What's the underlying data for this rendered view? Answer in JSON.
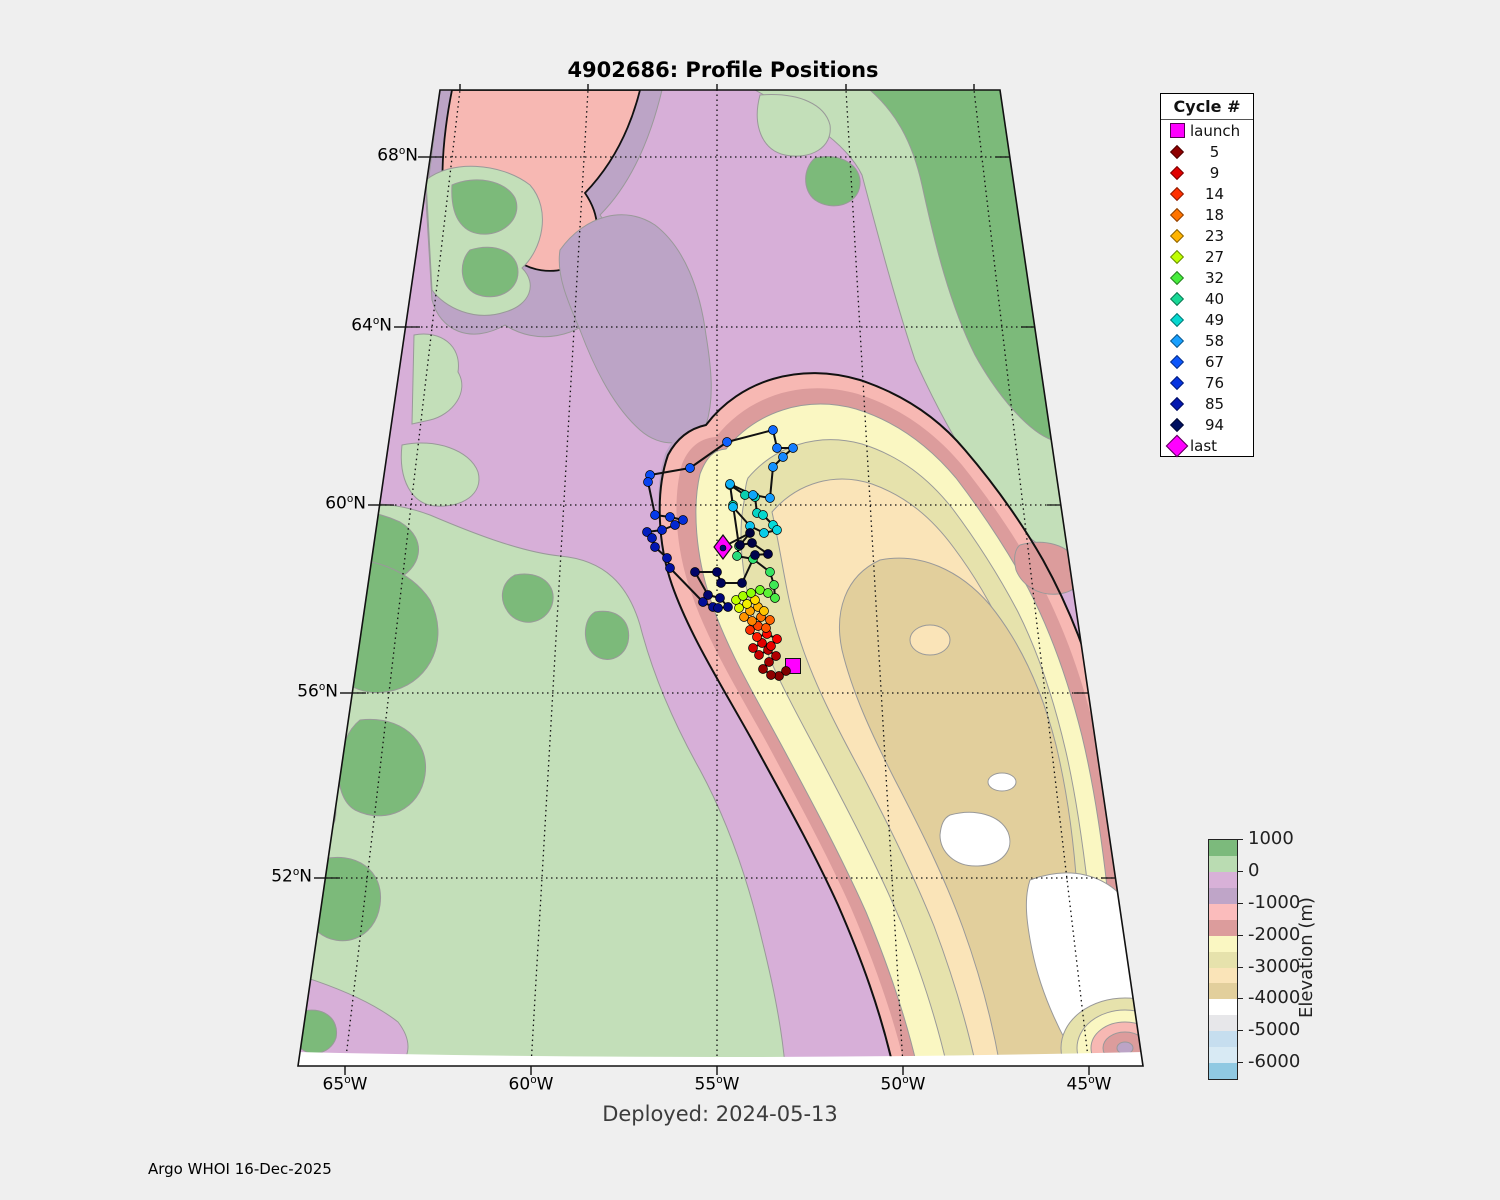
{
  "figure": {
    "title": "4902686: Profile Positions",
    "deployed_label": "Deployed: 2024-05-13",
    "credit": "Argo WHOI 16-Dec-2025"
  },
  "axes": {
    "lat_ticks": [
      {
        "pre": "68",
        "sup": "o",
        "post": "N"
      },
      {
        "pre": "64",
        "sup": "o",
        "post": "N"
      },
      {
        "pre": "60",
        "sup": "o",
        "post": "N"
      },
      {
        "pre": "56",
        "sup": "o",
        "post": "N"
      },
      {
        "pre": "52",
        "sup": "o",
        "post": "N"
      }
    ],
    "lon_ticks": [
      {
        "pre": "65",
        "sup": "o",
        "post": "W"
      },
      {
        "pre": "60",
        "sup": "o",
        "post": "W"
      },
      {
        "pre": "55",
        "sup": "o",
        "post": "W"
      },
      {
        "pre": "50",
        "sup": "o",
        "post": "W"
      },
      {
        "pre": "45",
        "sup": "o",
        "post": "W"
      }
    ]
  },
  "legend": {
    "title": "Cycle #",
    "items": [
      {
        "label": "launch",
        "color": "#FF00FF",
        "marker": "square"
      },
      {
        "label": "5",
        "color": "#8F0000",
        "marker": "diamond"
      },
      {
        "label": "9",
        "color": "#E00000",
        "marker": "diamond"
      },
      {
        "label": "14",
        "color": "#FF3000",
        "marker": "diamond"
      },
      {
        "label": "18",
        "color": "#FF7400",
        "marker": "diamond"
      },
      {
        "label": "23",
        "color": "#FFB400",
        "marker": "diamond"
      },
      {
        "label": "27",
        "color": "#BFFF00",
        "marker": "diamond"
      },
      {
        "label": "32",
        "color": "#46EC3C",
        "marker": "diamond"
      },
      {
        "label": "40",
        "color": "#17D896",
        "marker": "diamond"
      },
      {
        "label": "49",
        "color": "#06D8D0",
        "marker": "diamond"
      },
      {
        "label": "58",
        "color": "#18A0FF",
        "marker": "diamond"
      },
      {
        "label": "67",
        "color": "#0C56FB",
        "marker": "diamond"
      },
      {
        "label": "76",
        "color": "#0534E0",
        "marker": "diamond"
      },
      {
        "label": "85",
        "color": "#0318B0",
        "marker": "diamond"
      },
      {
        "label": "94",
        "color": "#001060",
        "marker": "diamond"
      },
      {
        "label": "last",
        "color": "#FF00FF",
        "marker": "diamond-large"
      }
    ]
  },
  "colorbar": {
    "label": "Elevation (m)",
    "ticks": [
      "1000",
      "0",
      "-1000",
      "-2000",
      "-3000",
      "-4000",
      "-5000",
      "-6000"
    ],
    "segments": [
      "#7CBA7C",
      "#BADCB2",
      "#D8B1D8",
      "#BFA5C8",
      "#FBBCBC",
      "#DC9C9C",
      "#FAF7C2",
      "#E6E2AC",
      "#FAE4B8",
      "#E2CF9C",
      "#FFFFFF",
      "#E7E7EA",
      "#C6DEEF",
      "#D8EAF4",
      "#90C9E2"
    ]
  },
  "trajectory": {
    "line_color": "#111111",
    "launch": {
      "x": 793,
      "y": 666,
      "color": "#FF00FF"
    },
    "last": {
      "x": 723,
      "y": 547,
      "color": "#FF00FF"
    },
    "points": [
      [
        786,
        671,
        "#7F0000"
      ],
      [
        779,
        676,
        "#870000"
      ],
      [
        771,
        675,
        "#8F0000"
      ],
      [
        763,
        669,
        "#970000"
      ],
      [
        769,
        662,
        "#A30000"
      ],
      [
        776,
        656,
        "#AF0000"
      ],
      [
        768,
        650,
        "#BB0000"
      ],
      [
        759,
        655,
        "#C70000"
      ],
      [
        753,
        648,
        "#D30000"
      ],
      [
        762,
        643,
        "#DF0000"
      ],
      [
        771,
        646,
        "#EB0000"
      ],
      [
        777,
        639,
        "#F70000"
      ],
      [
        767,
        634,
        "#FF0800"
      ],
      [
        757,
        637,
        "#FF1C00"
      ],
      [
        750,
        630,
        "#FF3000"
      ],
      [
        758,
        626,
        "#FF4400"
      ],
      [
        766,
        628,
        "#FF5400"
      ],
      [
        770,
        620,
        "#FF6400"
      ],
      [
        761,
        617,
        "#FF7400"
      ],
      [
        752,
        621,
        "#FF8400"
      ],
      [
        744,
        617,
        "#FF9400"
      ],
      [
        750,
        611,
        "#FFA400"
      ],
      [
        758,
        607,
        "#FFB400"
      ],
      [
        764,
        611,
        "#FFC400"
      ],
      [
        755,
        600,
        "#FFDC00"
      ],
      [
        747,
        604,
        "#F2EE00"
      ],
      [
        739,
        608,
        "#D9FB00"
      ],
      [
        736,
        600,
        "#BFFF00"
      ],
      [
        743,
        596,
        "#A5FF00"
      ],
      [
        751,
        593,
        "#8BFF08"
      ],
      [
        760,
        590,
        "#6FFA1E"
      ],
      [
        768,
        593,
        "#5BF235"
      ],
      [
        775,
        598,
        "#4AEC46"
      ],
      [
        774,
        585,
        "#3FE855"
      ],
      [
        770,
        572,
        "#36E462"
      ],
      [
        753,
        559,
        "#2EDF6F"
      ],
      [
        737,
        556,
        "#26DB7C"
      ],
      [
        739,
        546,
        "#1ED689"
      ],
      [
        733,
        505,
        "#16D196"
      ],
      [
        730,
        485,
        "#0ECCA3"
      ],
      [
        745,
        495,
        "#0BCFAE"
      ],
      [
        755,
        497,
        "#08D2B9"
      ],
      [
        757,
        513,
        "#06D5C4"
      ],
      [
        763,
        515,
        "#04D8CF"
      ],
      [
        773,
        525,
        "#04DCDA"
      ],
      [
        777,
        530,
        "#06D5E2"
      ],
      [
        764,
        533,
        "#08CDE8"
      ],
      [
        750,
        526,
        "#0AC4EE"
      ],
      [
        733,
        507,
        "#0CBAF3"
      ],
      [
        730,
        484,
        "#0EB0F7"
      ],
      [
        753,
        495,
        "#10A6FA"
      ],
      [
        770,
        498,
        "#129CFD"
      ],
      [
        773,
        467,
        "#1492FF"
      ],
      [
        783,
        457,
        "#1588FF"
      ],
      [
        793,
        448,
        "#147EFF"
      ],
      [
        777,
        448,
        "#1274FF"
      ],
      [
        773,
        430,
        "#106AFF"
      ],
      [
        727,
        442,
        "#0E60FF"
      ],
      [
        690,
        468,
        "#0C56FB"
      ],
      [
        650,
        475,
        "#0A4CF5"
      ],
      [
        648,
        482,
        "#0842EF"
      ],
      [
        655,
        515,
        "#063AE8"
      ],
      [
        670,
        517,
        "#0534E0"
      ],
      [
        683,
        520,
        "#042ED8"
      ],
      [
        675,
        525,
        "#0428D0"
      ],
      [
        662,
        530,
        "#0322C8"
      ],
      [
        647,
        532,
        "#031EC0"
      ],
      [
        652,
        538,
        "#021AB8"
      ],
      [
        655,
        547,
        "#0216B0"
      ],
      [
        667,
        558,
        "#0212A8"
      ],
      [
        670,
        568,
        "#0210A0"
      ],
      [
        703,
        602,
        "#020E98"
      ],
      [
        713,
        607,
        "#010C90"
      ],
      [
        718,
        608,
        "#010A88"
      ],
      [
        728,
        607,
        "#010880"
      ],
      [
        720,
        598,
        "#010678"
      ],
      [
        708,
        595,
        "#010570"
      ],
      [
        695,
        572,
        "#010468"
      ],
      [
        717,
        572,
        "#000360"
      ],
      [
        721,
        583,
        "#000358"
      ],
      [
        742,
        583,
        "#000250"
      ],
      [
        755,
        555,
        "#00024C"
      ],
      [
        768,
        554,
        "#000248"
      ],
      [
        752,
        543,
        "#000144"
      ],
      [
        740,
        545,
        "#000140"
      ],
      [
        750,
        533,
        "#00013C"
      ]
    ]
  }
}
